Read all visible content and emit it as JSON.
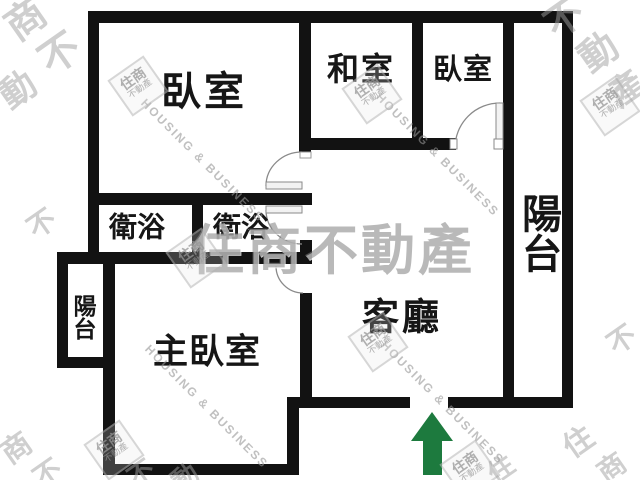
{
  "plan": {
    "rooms": [
      {
        "key": "bedroom-top-left",
        "label": "臥室"
      },
      {
        "key": "tatami-room",
        "label": "和室"
      },
      {
        "key": "bedroom-top-right",
        "label": "臥室"
      },
      {
        "key": "balcony-right",
        "label": "陽台"
      },
      {
        "key": "bathroom-left",
        "label": "衛浴"
      },
      {
        "key": "bathroom-right",
        "label": "衛浴"
      },
      {
        "key": "balcony-left",
        "label": "陽台"
      },
      {
        "key": "master-bedroom",
        "label": "主臥室"
      },
      {
        "key": "living-room",
        "label": "客廳"
      }
    ]
  },
  "watermark": {
    "brand": "住商不動產",
    "brand_en": "HOUSING & BUSINESS",
    "logo_line1": "住商",
    "logo_line2": "不動產",
    "scatter": [
      "商",
      "不",
      "動",
      "不",
      "動",
      "產",
      "不",
      "商",
      "不",
      "不",
      "動",
      "住",
      "住",
      "商",
      "不"
    ]
  },
  "colors": {
    "wall": "#121212",
    "entrance_arrow": "#1d7a3e",
    "watermark_gray": "#9a9a9a"
  }
}
